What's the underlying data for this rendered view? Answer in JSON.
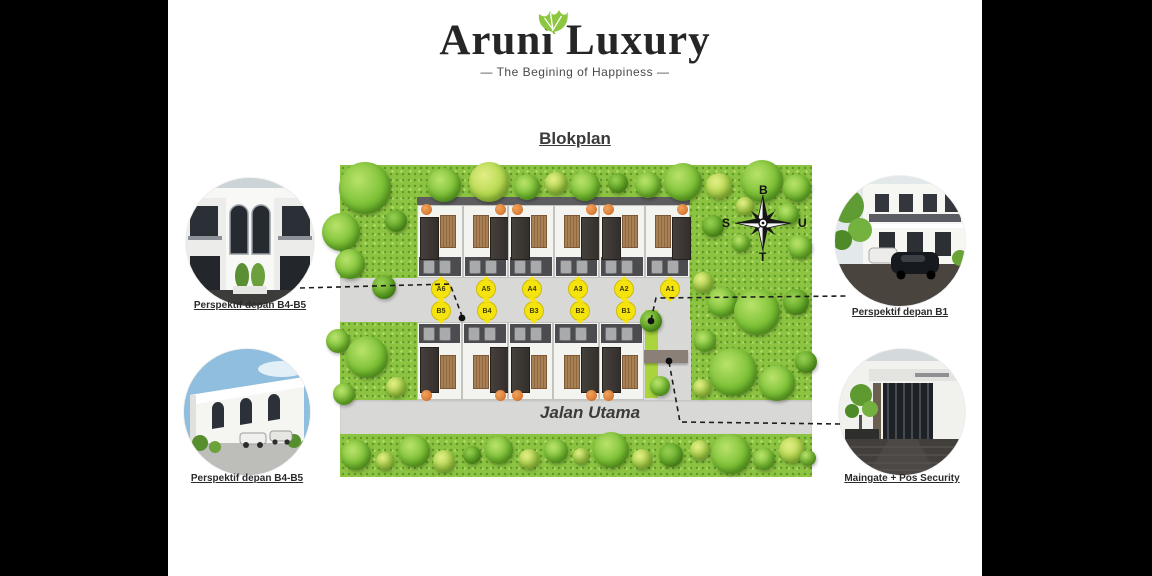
{
  "header": {
    "title": "Aruni Luxury",
    "tagline": "—  The Begining of Happiness  —"
  },
  "plan": {
    "heading": "Blokplan",
    "road_label": "Jalan Utama",
    "unit_labels_a": [
      "A6",
      "A5",
      "A4",
      "A3",
      "A2",
      "A1"
    ],
    "unit_labels_b": [
      "B5",
      "B4",
      "B3",
      "B2",
      "B1"
    ]
  },
  "compass": {
    "top": "B",
    "right": "U",
    "bottom": "T",
    "left": "S"
  },
  "insets": {
    "top_left": {
      "caption": "Perspektif depan B4-B5"
    },
    "bottom_left": {
      "caption": "Perspektif depan B4-B5"
    },
    "top_right": {
      "caption": "Perspektif depan B1"
    },
    "bottom_right": {
      "caption": "Maingate + Pos Security"
    }
  },
  "colors": {
    "leaf_accent": "#8dc63f",
    "badge_yellow": "#f4e30e",
    "grass_green": "#8cc441",
    "road_gray": "#d8d8d6"
  }
}
